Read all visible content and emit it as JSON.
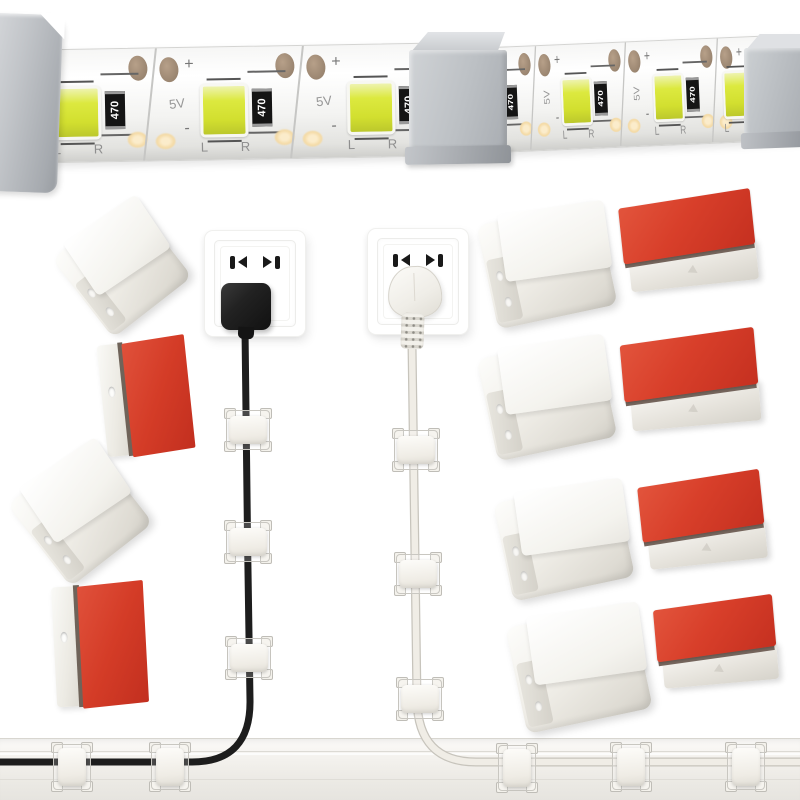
{
  "led_strip": {
    "labels": {
      "voltage": "5V",
      "resistor": "470",
      "plus": "+",
      "minus": "-",
      "left": "L",
      "right": "R"
    },
    "left_strip_units_x": [
      50,
      197,
      344
    ],
    "right_strip_units_x": [
      45,
      135,
      227,
      297
    ]
  },
  "colors": {
    "adhesive_red": "#d43c27",
    "clip_white": "#f1efe9",
    "aluminum_gray": "#b4b7bb",
    "led_chip_yellow": "#d2df2f",
    "black_cable": "#1d1d1d",
    "white_cable": "#f0ede6",
    "background": "#ffffff"
  },
  "outlets": {
    "left_plug_color": "black",
    "right_plug_color": "white"
  },
  "clips": {
    "loose_left": [
      {
        "variant": "white",
        "x": 72,
        "y": 218,
        "w": 100,
        "h": 100,
        "rot": -38
      },
      {
        "variant": "red-side",
        "x": 102,
        "y": 340,
        "w": 88,
        "h": 114,
        "rot": -6
      },
      {
        "variant": "white",
        "x": 28,
        "y": 462,
        "w": 104,
        "h": 104,
        "rot": -38
      },
      {
        "variant": "red-side",
        "x": 54,
        "y": 584,
        "w": 92,
        "h": 122,
        "rot": -3
      }
    ],
    "grid_right": [
      {
        "variant": "white",
        "x": 486,
        "y": 212,
        "w": 122,
        "h": 106,
        "rot": -12
      },
      {
        "variant": "red-top",
        "x": 622,
        "y": 198,
        "w": 136,
        "h": 90,
        "rot": -6
      },
      {
        "variant": "white",
        "x": 486,
        "y": 346,
        "w": 122,
        "h": 104,
        "rot": -12
      },
      {
        "variant": "red-top",
        "x": 623,
        "y": 336,
        "w": 138,
        "h": 92,
        "rot": -5
      },
      {
        "variant": "white",
        "x": 502,
        "y": 490,
        "w": 124,
        "h": 100,
        "rot": -12
      },
      {
        "variant": "red-top",
        "x": 641,
        "y": 478,
        "w": 126,
        "h": 88,
        "rot": -6
      },
      {
        "variant": "white",
        "x": 515,
        "y": 614,
        "w": 128,
        "h": 108,
        "rot": -12
      },
      {
        "variant": "red-top",
        "x": 656,
        "y": 602,
        "w": 122,
        "h": 84,
        "rot": -5
      }
    ],
    "on_vertical_cables": [
      {
        "x": 225,
        "y": 409
      },
      {
        "x": 225,
        "y": 521
      },
      {
        "x": 226,
        "y": 637
      },
      {
        "x": 393,
        "y": 429
      },
      {
        "x": 395,
        "y": 553
      },
      {
        "x": 397,
        "y": 678
      }
    ],
    "on_horizontal_cables": [
      {
        "x": 52,
        "y": 743
      },
      {
        "x": 150,
        "y": 743
      },
      {
        "x": 497,
        "y": 744
      },
      {
        "x": 611,
        "y": 743
      },
      {
        "x": 726,
        "y": 743
      }
    ]
  }
}
